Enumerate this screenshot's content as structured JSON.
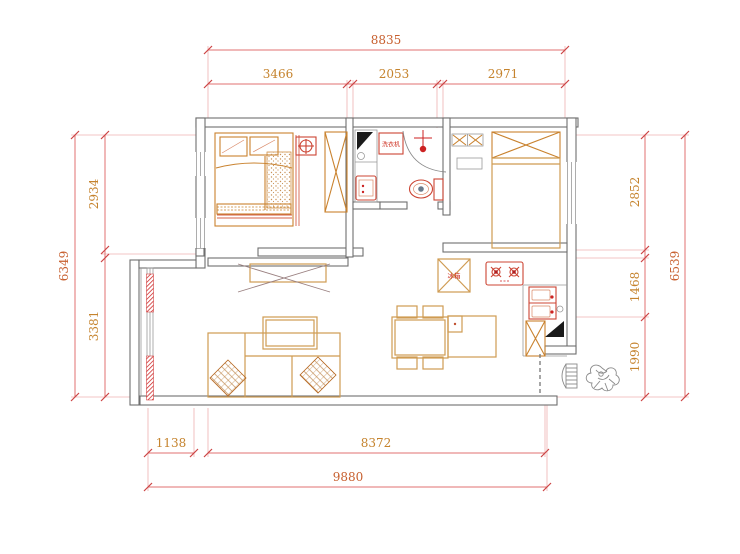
{
  "colors": {
    "dimension_line": "#e07070",
    "dimension_text": "#c5832d",
    "dimension_total_text": "#c75f2e",
    "wall": "#6f6f6f",
    "furniture_light": "#cf9b52",
    "furniture_dark": "#c9822e",
    "fixture_red": "#cc4433",
    "accent_red": "#cc2222"
  },
  "dimensions": {
    "top": {
      "total": "8835",
      "segments": [
        "3466",
        "2053",
        "2971"
      ]
    },
    "left": {
      "total": "6349",
      "segments": [
        "2934",
        "3381"
      ]
    },
    "right": {
      "total": "6539",
      "segments": [
        "2852",
        "1468",
        "1990"
      ]
    },
    "bottom": {
      "total": "9880",
      "segments": [
        "1138",
        "8372"
      ]
    }
  },
  "labels": {
    "washing_machine": "洗衣机",
    "refrigerator": "冰箱"
  },
  "icons": {
    "shower_head": "cross-and-dot",
    "ceiling_light": "circle-cross-in-square",
    "wardrobe": "rect-with-x",
    "entry_plant": "hand-drawn-plant-sketch",
    "counter_corner": "filled-black-triangle"
  }
}
